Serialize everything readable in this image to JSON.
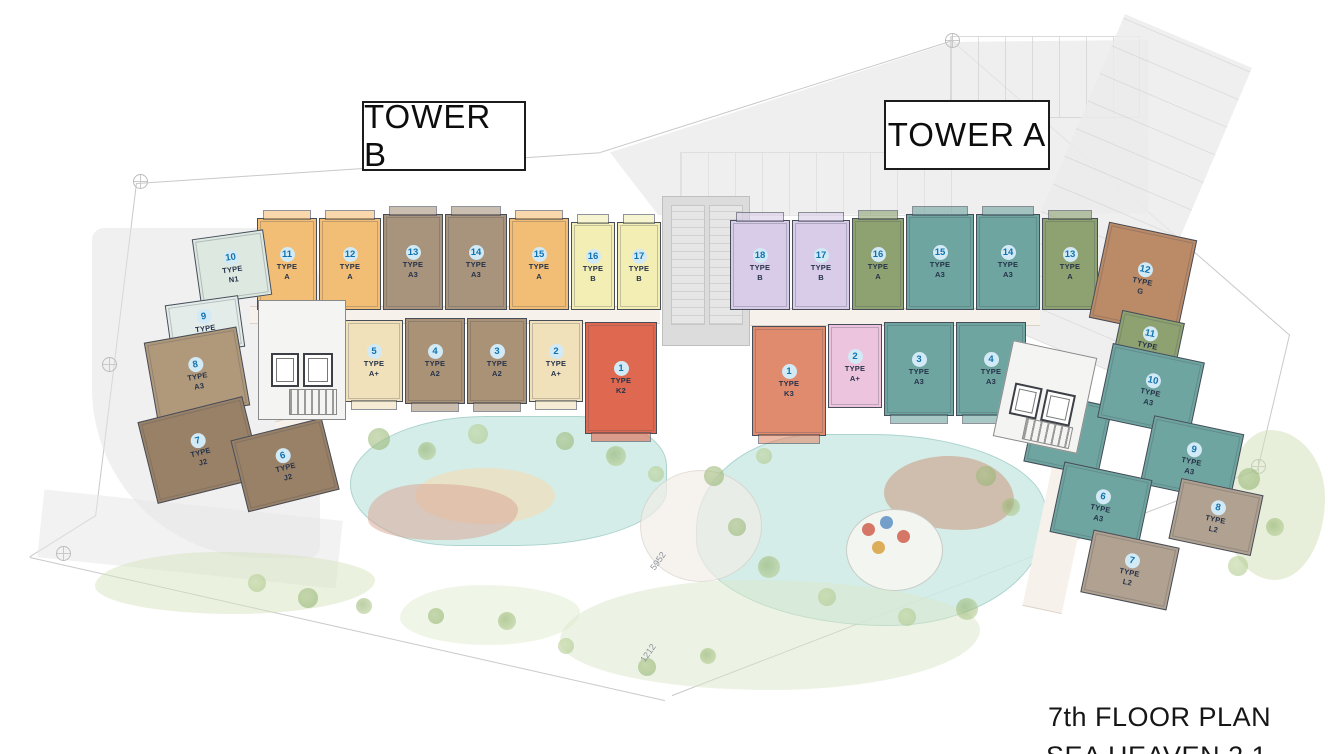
{
  "title": {
    "line1": "7th FLOOR PLAN",
    "line2": "SEA HEAVEN 2.1"
  },
  "towers": {
    "b": {
      "label": "TOWER B"
    },
    "a": {
      "label": "TOWER A"
    }
  },
  "ui": {
    "type_word": "TYPE"
  },
  "annotations": {
    "dim_left": "5952",
    "dim_bottom": "1212"
  },
  "palette": {
    "wall": "#474d59",
    "badge_bg": "#d2e9f6",
    "badge_text": "#1173ad",
    "pool": "#cdeae5",
    "site_gray": "#e9e9e9"
  },
  "units_b": [
    {
      "no": "11",
      "type": "A",
      "color": "#f2bd74"
    },
    {
      "no": "12",
      "type": "A",
      "color": "#f2bd74"
    },
    {
      "no": "13",
      "type": "A3",
      "color": "#a8937c"
    },
    {
      "no": "14",
      "type": "A3",
      "color": "#a8937c"
    },
    {
      "no": "15",
      "type": "A",
      "color": "#f2bd74"
    },
    {
      "no": "16",
      "type": "B",
      "color": "#f3eeb4"
    },
    {
      "no": "17",
      "type": "B",
      "color": "#f3eeb4"
    },
    {
      "no": "5",
      "type": "A+",
      "color": "#f1e1bb"
    },
    {
      "no": "4",
      "type": "A2",
      "color": "#aa9277"
    },
    {
      "no": "3",
      "type": "A2",
      "color": "#aa9277"
    },
    {
      "no": "2",
      "type": "A+",
      "color": "#f1e1bb"
    },
    {
      "no": "1",
      "type": "K2",
      "color": "#df6950"
    },
    {
      "no": "10",
      "type": "N1",
      "color": "#dce8e0"
    },
    {
      "no": "9",
      "type": "N2",
      "color": "#e3ece8"
    },
    {
      "no": "8",
      "type": "A3",
      "color": "#b0997b"
    },
    {
      "no": "7",
      "type": "J2",
      "color": "#998167"
    },
    {
      "no": "6",
      "type": "J2",
      "color": "#998167"
    }
  ],
  "units_a": [
    {
      "no": "18",
      "type": "B",
      "color": "#d8cce9"
    },
    {
      "no": "17",
      "type": "B",
      "color": "#d8cce9"
    },
    {
      "no": "16",
      "type": "A",
      "color": "#8ea271"
    },
    {
      "no": "15",
      "type": "A3",
      "color": "#6fa5a0"
    },
    {
      "no": "14",
      "type": "A3",
      "color": "#6fa5a0"
    },
    {
      "no": "13",
      "type": "A",
      "color": "#8ea271"
    },
    {
      "no": "12",
      "type": "G",
      "color": "#bb8a67"
    },
    {
      "no": "11",
      "type": "A",
      "color": "#8ea271"
    },
    {
      "no": "1",
      "type": "K3",
      "color": "#e08b6e"
    },
    {
      "no": "2",
      "type": "A+",
      "color": "#edc4de"
    },
    {
      "no": "3",
      "type": "A3",
      "color": "#6fa5a0"
    },
    {
      "no": "4",
      "type": "A3",
      "color": "#6fa5a0"
    },
    {
      "no": "5",
      "type": "A3",
      "color": "#6fa5a0"
    },
    {
      "no": "10",
      "type": "A3",
      "color": "#6fa5a0"
    },
    {
      "no": "9",
      "type": "A3",
      "color": "#6fa5a0"
    },
    {
      "no": "6",
      "type": "A3",
      "color": "#6fa5a0"
    },
    {
      "no": "8",
      "type": "L2",
      "color": "#b0a190"
    },
    {
      "no": "7",
      "type": "L2",
      "color": "#b0a190"
    }
  ]
}
